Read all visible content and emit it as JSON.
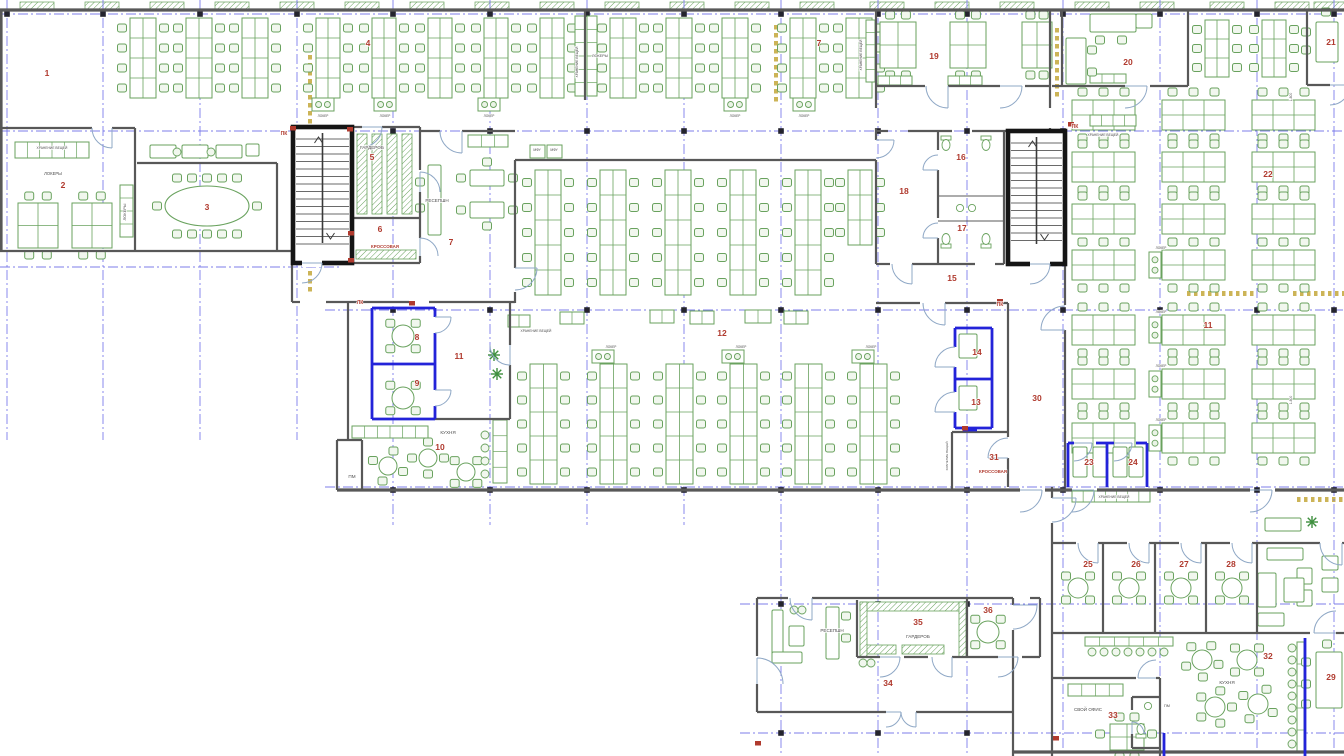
{
  "drawing": {
    "kind": "office-floor-plan"
  },
  "canvas": {
    "width": 1344,
    "height": 756,
    "background": "#ffffff"
  },
  "colors": {
    "wall": "#585858",
    "stair": "#151515",
    "blue_wall": "#2323d9",
    "furniture": "#69a25e",
    "grid": "#7070e8",
    "room_number": "#b03a2e",
    "label": "#4c4c4c",
    "joint": "#bfa12d",
    "door": "#8fa8c6"
  },
  "rooms": [
    {
      "num": "1",
      "x": 47,
      "y": 76
    },
    {
      "num": "2",
      "x": 63,
      "y": 188
    },
    {
      "num": "3",
      "x": 207,
      "y": 210
    },
    {
      "num": "4",
      "x": 368,
      "y": 46
    },
    {
      "num": "5",
      "x": 372,
      "y": 160
    },
    {
      "num": "6",
      "x": 380,
      "y": 232
    },
    {
      "num": "7",
      "x": 451,
      "y": 245
    },
    {
      "num": "7",
      "x": 819,
      "y": 46
    },
    {
      "num": "8",
      "x": 417,
      "y": 340
    },
    {
      "num": "9",
      "x": 417,
      "y": 386
    },
    {
      "num": "10",
      "x": 440,
      "y": 450
    },
    {
      "num": "11",
      "x": 459,
      "y": 359
    },
    {
      "num": "11",
      "x": 1208,
      "y": 328
    },
    {
      "num": "12",
      "x": 722,
      "y": 336
    },
    {
      "num": "13",
      "x": 976,
      "y": 405
    },
    {
      "num": "14",
      "x": 977,
      "y": 355
    },
    {
      "num": "15",
      "x": 952,
      "y": 281
    },
    {
      "num": "16",
      "x": 961,
      "y": 160
    },
    {
      "num": "17",
      "x": 962,
      "y": 231
    },
    {
      "num": "18",
      "x": 904,
      "y": 194
    },
    {
      "num": "19",
      "x": 934,
      "y": 59
    },
    {
      "num": "20",
      "x": 1128,
      "y": 65
    },
    {
      "num": "21",
      "x": 1331,
      "y": 45
    },
    {
      "num": "22",
      "x": 1268,
      "y": 177
    },
    {
      "num": "23",
      "x": 1089,
      "y": 465
    },
    {
      "num": "24",
      "x": 1133,
      "y": 465
    },
    {
      "num": "25",
      "x": 1088,
      "y": 567
    },
    {
      "num": "26",
      "x": 1136,
      "y": 567
    },
    {
      "num": "27",
      "x": 1184,
      "y": 567
    },
    {
      "num": "28",
      "x": 1231,
      "y": 567
    },
    {
      "num": "29",
      "x": 1331,
      "y": 680
    },
    {
      "num": "30",
      "x": 1037,
      "y": 401
    },
    {
      "num": "31",
      "x": 994,
      "y": 460
    },
    {
      "num": "32",
      "x": 1268,
      "y": 659
    },
    {
      "num": "33",
      "x": 1113,
      "y": 718
    },
    {
      "num": "34",
      "x": 888,
      "y": 686
    },
    {
      "num": "35",
      "x": 918,
      "y": 625
    },
    {
      "num": "36",
      "x": 988,
      "y": 613
    }
  ],
  "red_labels": [
    {
      "text": "КРОССОВАЯ",
      "x": 385,
      "y": 248,
      "size": 4.4
    },
    {
      "text": "КРОССОВАЯ",
      "x": 993,
      "y": 473,
      "size": 4.4
    },
    {
      "text": "ПК",
      "x": 284,
      "y": 135,
      "size": 5
    },
    {
      "text": "ПК",
      "x": 1000,
      "y": 306,
      "size": 5
    },
    {
      "text": "ПК",
      "x": 1075,
      "y": 128,
      "size": 5
    },
    {
      "text": "ЛК",
      "x": 360,
      "y": 304,
      "size": 5
    }
  ],
  "annotations": [
    {
      "text": "ГАРДЕРОБ",
      "x": 372,
      "y": 149,
      "size": 4.6
    },
    {
      "text": "РЕСЕПШН",
      "x": 437,
      "y": 202,
      "size": 4.6
    },
    {
      "text": "КУХНЯ",
      "x": 448,
      "y": 434,
      "size": 4.6
    },
    {
      "text": "КУХНЯ",
      "x": 1227,
      "y": 684,
      "size": 4.6
    },
    {
      "text": "РЕСЕПШН",
      "x": 832,
      "y": 632,
      "size": 4.6
    },
    {
      "text": "ГАРДЕРОБ",
      "x": 918,
      "y": 638,
      "size": 4.6
    },
    {
      "text": "СВОЙ ОФИС",
      "x": 1088,
      "y": 711,
      "size": 4.6
    },
    {
      "text": "ПМ",
      "x": 352,
      "y": 478,
      "size": 4.6
    },
    {
      "text": "ПМ",
      "x": 1167,
      "y": 707,
      "size": 3.8
    },
    {
      "text": "МФУ",
      "x": 537,
      "y": 151,
      "size": 3.4
    },
    {
      "text": "МФУ",
      "x": 554,
      "y": 151,
      "size": 3.4
    },
    {
      "text": "ЛОКЕРЫ",
      "x": 53,
      "y": 175,
      "size": 4.2
    },
    {
      "text": "ЛОКЕРЫ",
      "x": 600,
      "y": 57,
      "size": 3.8
    },
    {
      "text": "ЛОКЕРЫ",
      "x": 126,
      "y": 212,
      "size": 4,
      "rot": -90
    },
    {
      "text": "ХРАНЕНИЕ ВЕЩЕЙ",
      "x": 52,
      "y": 149,
      "size": 3.3
    },
    {
      "text": "ХРАНЕНИЕ ВЕЩЕЙ",
      "x": 536,
      "y": 332,
      "size": 3.3
    },
    {
      "text": "ХРАНЕНИЕ ВЕЩЕЙ",
      "x": 1103,
      "y": 136,
      "size": 3.3
    },
    {
      "text": "ХРАНЕНИЕ ВЕЩЕЙ",
      "x": 1114,
      "y": 498,
      "size": 3.3
    },
    {
      "text": "ХРАНЕНИЕ ВЕЩЕЙ",
      "x": 862,
      "y": 55,
      "size": 3.3,
      "rot": -90
    },
    {
      "text": "ХРАНЕНИЕ ВЕЩЕЙ",
      "x": 578,
      "y": 62,
      "size": 3.3,
      "rot": -90
    },
    {
      "text": "ХРАНЕНИЕ ВЕЩЕЙ",
      "x": 948,
      "y": 456,
      "size": 3.1,
      "rot": -90
    },
    {
      "text": "ЛОКЕР",
      "x": 323,
      "y": 117,
      "size": 3.2
    },
    {
      "text": "ЛОКЕР",
      "x": 385,
      "y": 117,
      "size": 3.2
    },
    {
      "text": "ЛОКЕР",
      "x": 489,
      "y": 117,
      "size": 3.2
    },
    {
      "text": "ЛОКЕР",
      "x": 735,
      "y": 117,
      "size": 3.2
    },
    {
      "text": "ЛОКЕР",
      "x": 804,
      "y": 117,
      "size": 3.2
    },
    {
      "text": "ЛОКЕР",
      "x": 611,
      "y": 348,
      "size": 3.2
    },
    {
      "text": "ЛОКЕР",
      "x": 741,
      "y": 348,
      "size": 3.2
    },
    {
      "text": "ЛОКЕР",
      "x": 871,
      "y": 348,
      "size": 3.2
    },
    {
      "text": "ЛОКЕР",
      "x": 1161,
      "y": 249,
      "size": 3.2
    },
    {
      "text": "ЛОКЕР",
      "x": 1161,
      "y": 313,
      "size": 3.2
    },
    {
      "text": "ЛОКЕР",
      "x": 1161,
      "y": 367,
      "size": 3.2
    },
    {
      "text": "ЛОКЕР",
      "x": 1161,
      "y": 421,
      "size": 3.2
    },
    {
      "text": "1.800",
      "x": 1292,
      "y": 97,
      "size": 3.4,
      "rot": -90
    },
    {
      "text": "1.800",
      "x": 1292,
      "y": 400,
      "size": 3.4,
      "rot": -90
    }
  ]
}
